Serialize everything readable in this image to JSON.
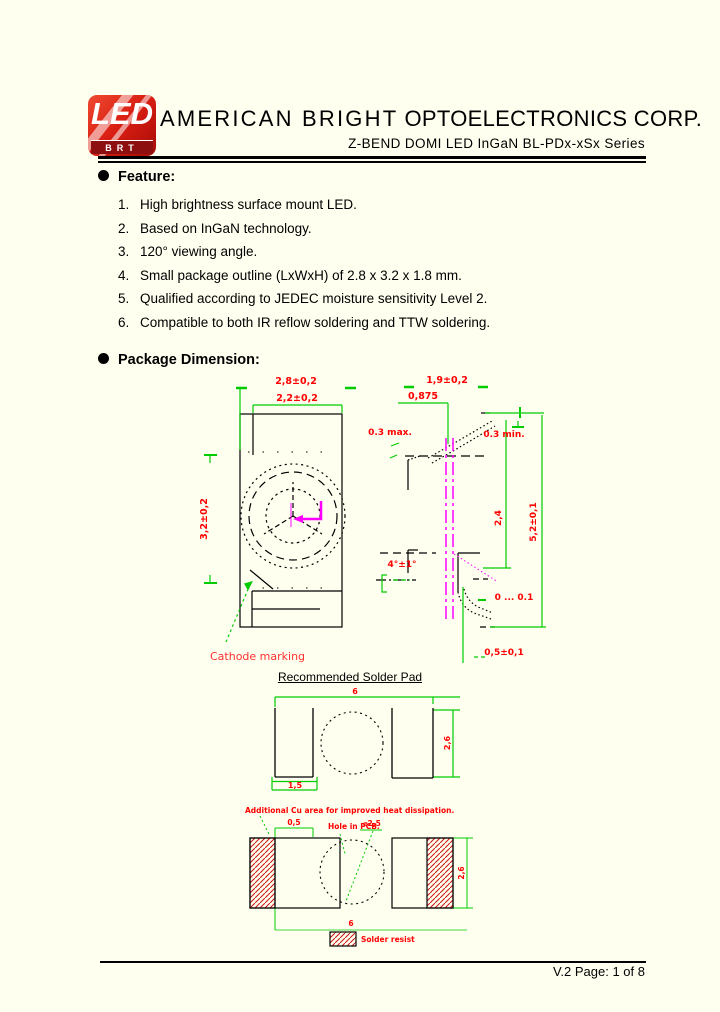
{
  "page": {
    "footer_text": "V.2 Page: 1 of 8"
  },
  "colors": {
    "page_bg": "#FFFFF0",
    "logo_red": "#D81D12",
    "dimension_red": "#FF0000",
    "dimension_green": "#00CC00",
    "centerline_magenta": "#FF00FF"
  },
  "header": {
    "logo_top": "LED",
    "logo_bottom": "BRT",
    "title_main": "AMERICAN BRIGHT",
    "title_rest": "OPTOELECTRONICS CORP.",
    "subtitle": "Z-BEND DOMI LED InGaN BL-PDx-xSx Series"
  },
  "features": {
    "heading": "Feature:",
    "items": [
      {
        "n": "1.",
        "t": "High brightness surface mount LED."
      },
      {
        "n": "2.",
        "t": "Based on InGaN technology."
      },
      {
        "n": "3.",
        "t": "120° viewing angle."
      },
      {
        "n": "4.",
        "t": "Small package outline (LxWxH) of 2.8 x 3.2 x 1.8 mm."
      },
      {
        "n": "5.",
        "t": "Qualified according to JEDEC moisture sensitivity Level 2."
      },
      {
        "n": "6.",
        "t": "Compatible to both IR reflow soldering and TTW soldering."
      }
    ]
  },
  "pkg": {
    "heading": "Package Dimension:",
    "top_view": {
      "w_outer": "2,8±0,2",
      "w_inner": "2,2±0,2",
      "h_body": "3,2±0,2",
      "cathode": "Cathode marking"
    },
    "side_view": {
      "lead_pitch": "1,9±0,2",
      "half_pitch": "0,875",
      "max03": "0.3 max.",
      "min03": "0.3 min.",
      "body_h": "2,4",
      "total_h": "5,2±0,1",
      "angle": "4°±1°",
      "gap": "0 ... 0.1",
      "standoff": "0,5±0,1"
    }
  },
  "solder": {
    "title": "Recommended Solder Pad",
    "width_total": "6",
    "pad_width": "1,5",
    "pad_height": "2,6"
  },
  "cu": {
    "note": "Additional Cu area for improved heat dissipation.",
    "cu_width": "0,5",
    "hole_label": "Hole in PCB.",
    "hole_dia": "⌀2,5",
    "pad_height": "2,6",
    "width_total": "6",
    "legend_label": "Solder resist"
  }
}
